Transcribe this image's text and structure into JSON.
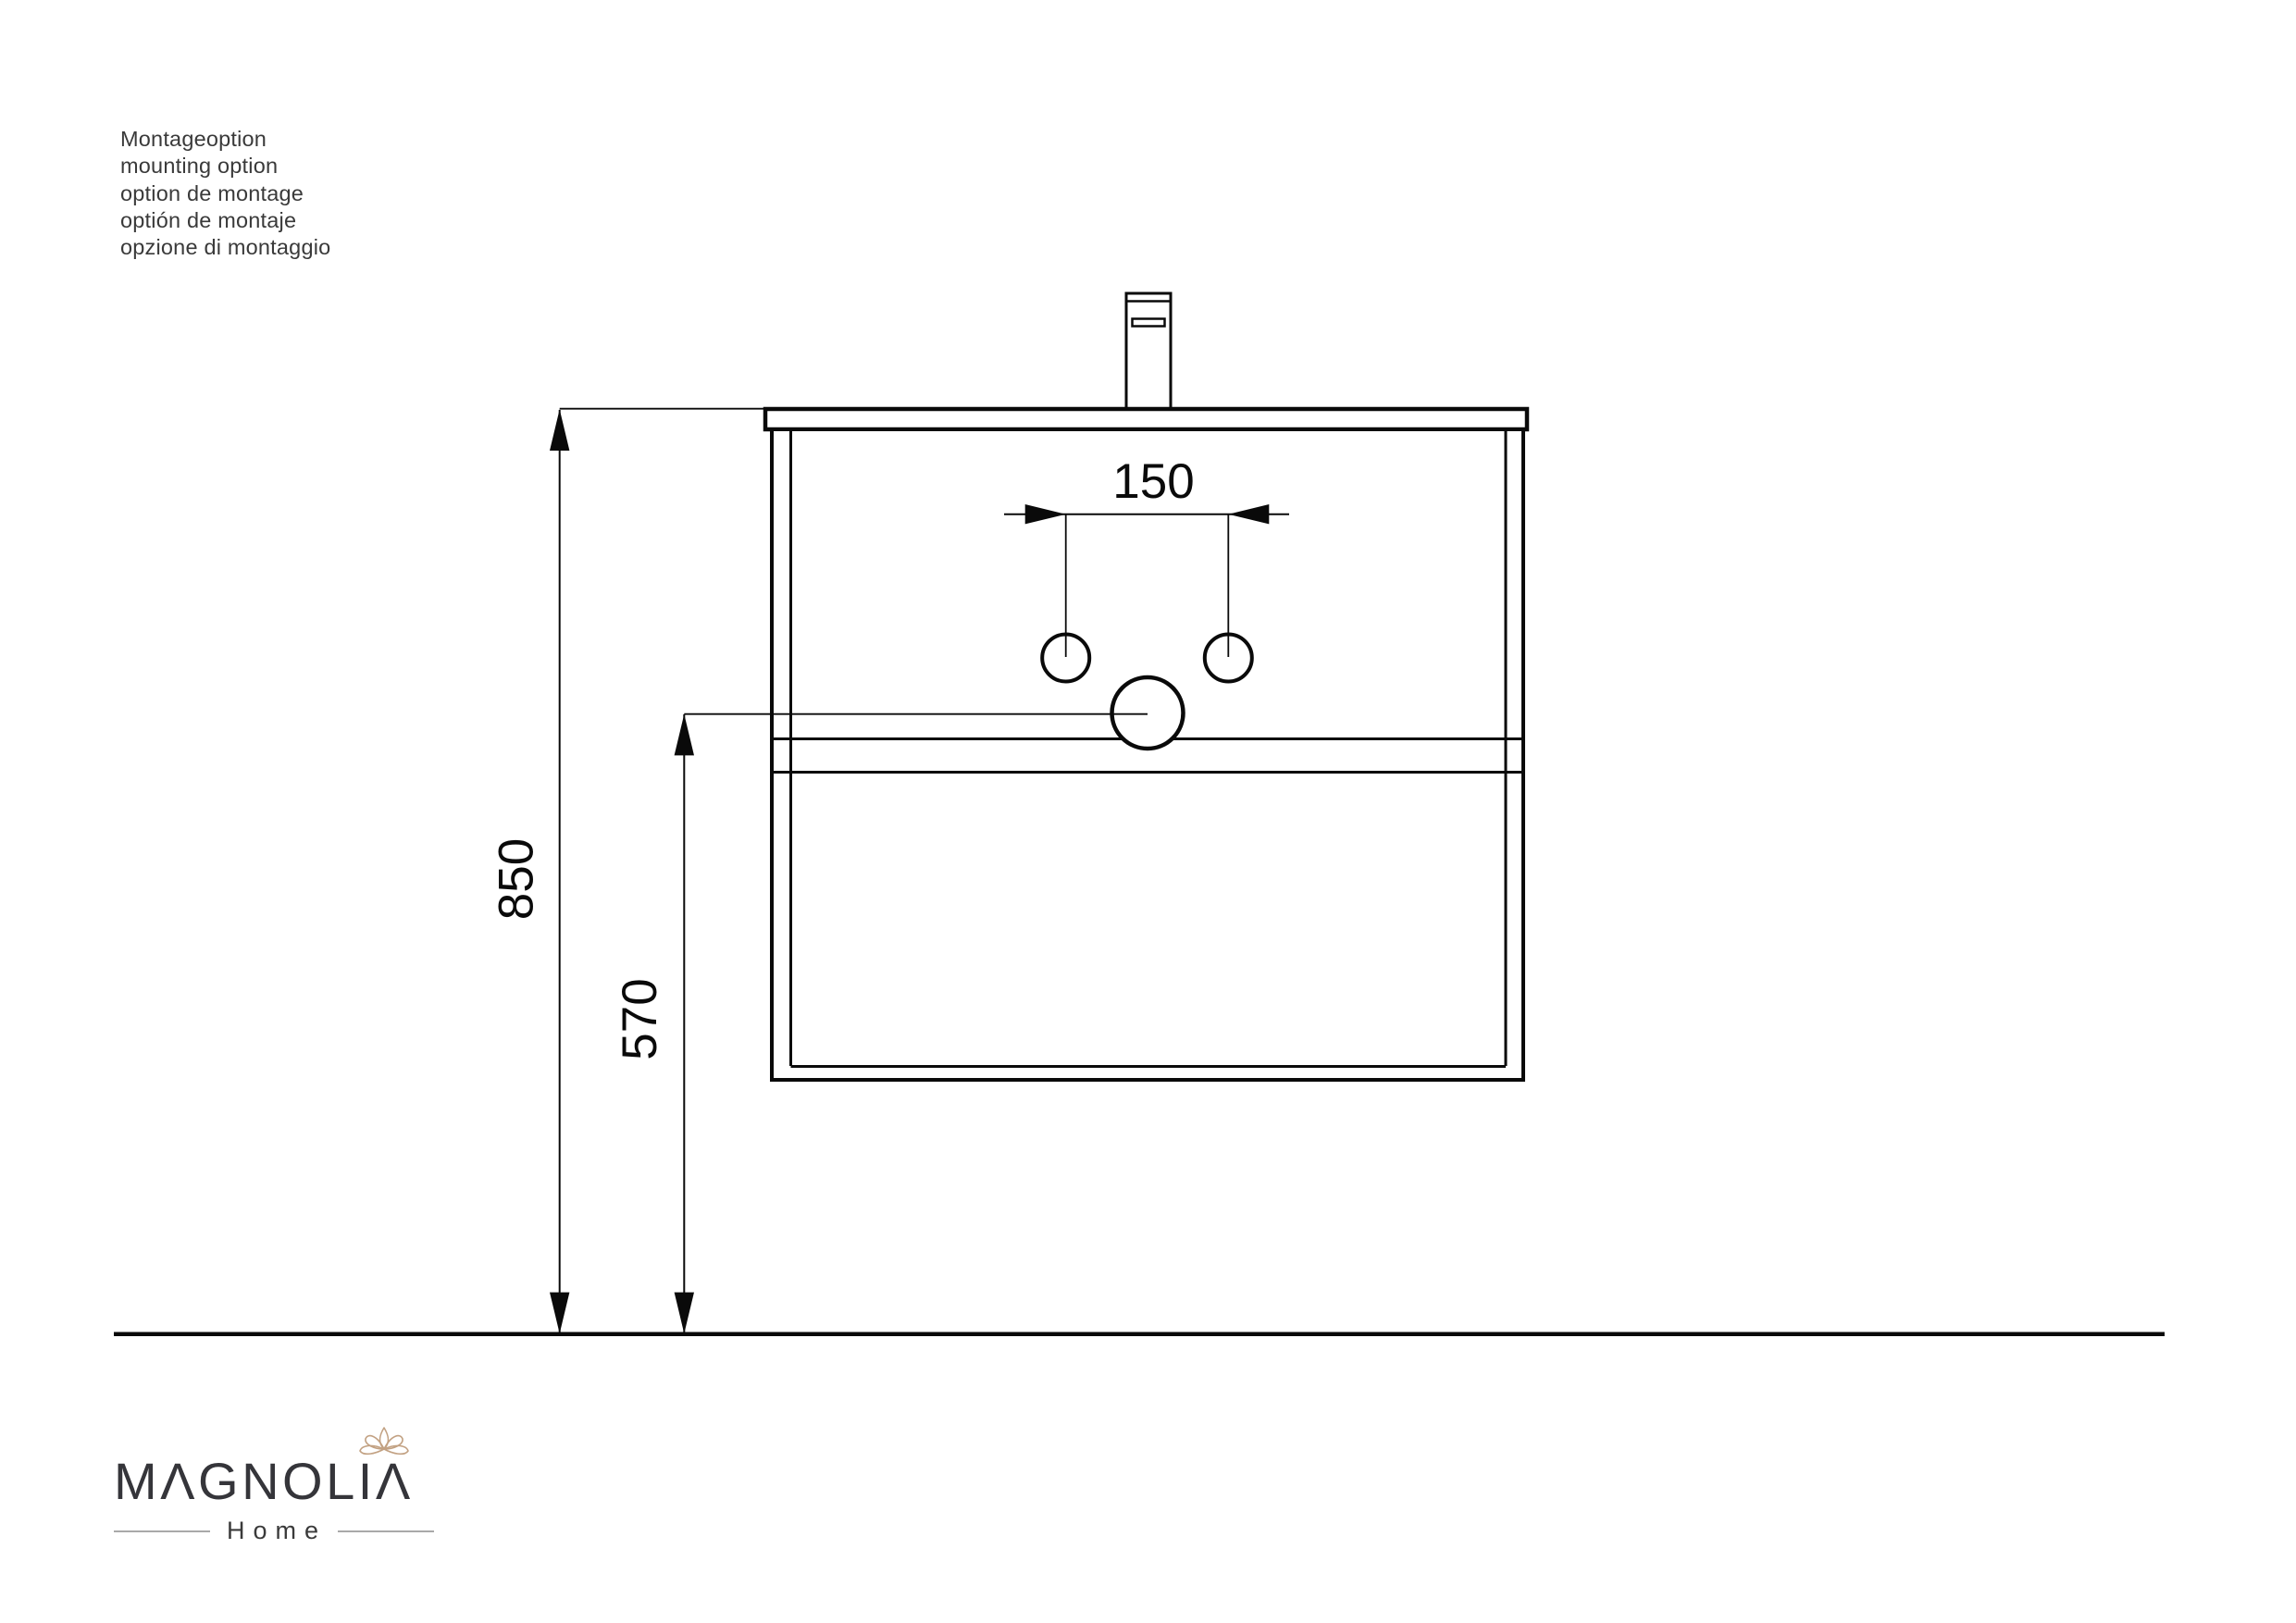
{
  "note": {
    "lines": [
      "Montageoption",
      "mounting option",
      "option de montage",
      "optión de montaje",
      "opzione di montaggio"
    ]
  },
  "drawing": {
    "dimensions": {
      "faucet_hole_spacing": "150",
      "countertop_height": "850",
      "drain_center_height": "570"
    }
  },
  "logo": {
    "brand": "MAGNOLIA",
    "brand_display": "MΛGNOLIΛ",
    "subtitle": "Home",
    "flower_icon": "magnolia-flower-icon",
    "accent_color": "#c2a182",
    "text_color": "#35353a"
  },
  "colors": {
    "line": "#0a0a0a",
    "text": "#3a3a3a",
    "background": "#ffffff"
  }
}
